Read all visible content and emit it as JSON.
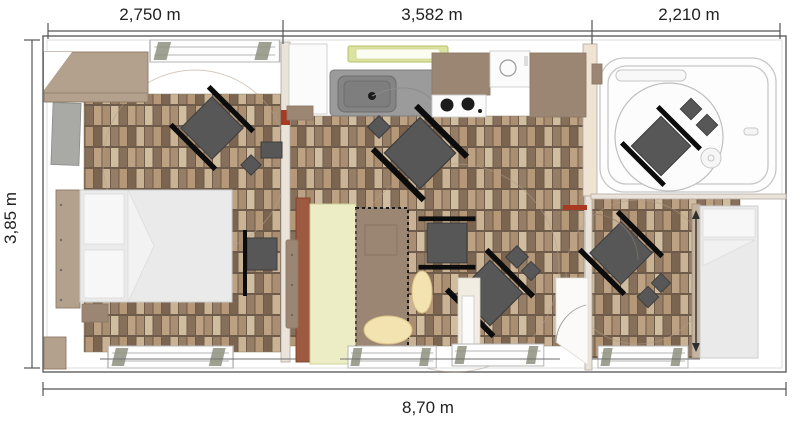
{
  "plan": {
    "type": "floor-plan",
    "dims": {
      "top_segments": [
        {
          "label": "2,750 m"
        },
        {
          "label": "3,582 m"
        },
        {
          "label": "2,210 m"
        }
      ],
      "left": {
        "label": "3,85 m"
      },
      "bottom": {
        "label": "8,70 m"
      }
    },
    "colors": {
      "dim-text": "#222222",
      "dim-line": "#555555",
      "outer-wall": "#5f5f5f",
      "wall-fill": "#e9e3da",
      "wall-edge": "#b3aa9e",
      "accent-red": "#a93a22",
      "window-green": "#dbe39f",
      "counter-gray": "#9b9b9b",
      "sink-gray": "#848484",
      "appliance-black": "#1c1c1c",
      "furniture-dark": "#575757",
      "chair-black": "#0c0c0c",
      "wood": "#b4a18d",
      "wood-edge": "#8d7a66",
      "wood-dark": "#9a8673",
      "bed-fill": "#eaeaea",
      "bed-edge": "#cccccc",
      "pillow": "#f7f7f7",
      "terracotta": "#9d5a40",
      "pale-yellow": "#ecedc4",
      "cream": "#f3e3b0",
      "cream-edge": "#d9c186",
      "rug-line": "#b39d88",
      "outline-light": "#c7c7c7",
      "parquet-bg": "#6e5b4a",
      "parquet-a": "#c9b394",
      "parquet-b": "#967e66",
      "parquet-c": "#b59877",
      "parquet-d": "#7b6450",
      "parquet-e": "#a98e72",
      "parquet-f": "#d0bc9e",
      "parquet-g": "#86705b",
      "parquet-h": "#bda183"
    }
  }
}
